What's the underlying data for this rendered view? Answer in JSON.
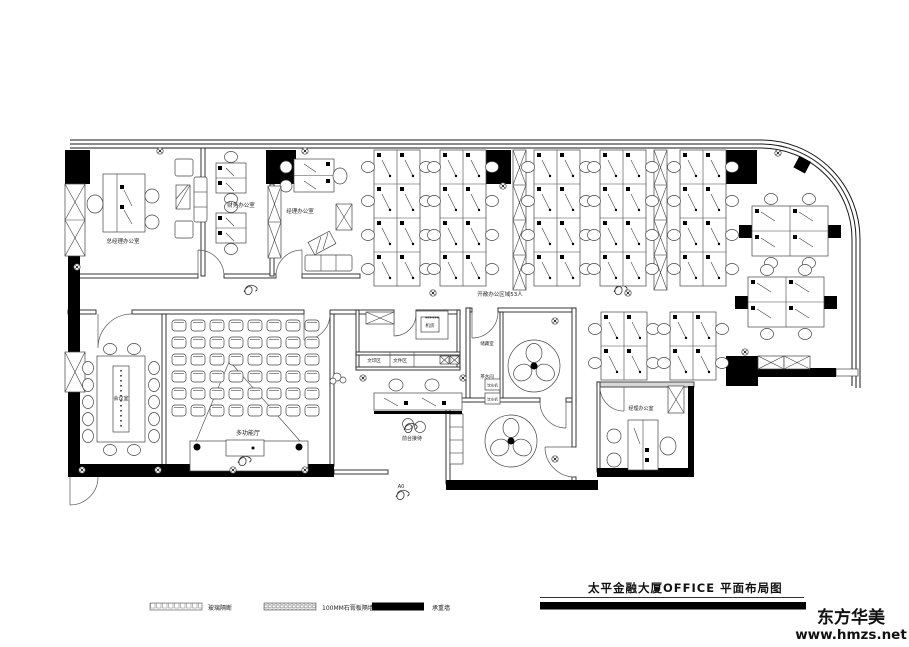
{
  "title_block": {
    "title": "太平金融大厦OFFICE  平面布局图"
  },
  "watermark": {
    "line1": "东方华美",
    "line2": "www.hmzs.net"
  },
  "legend": {
    "items": [
      {
        "label": "玻璃隔断",
        "style": "hatched"
      },
      {
        "label": "100MM石膏板隔墙",
        "style": "dotted"
      },
      {
        "label": "承重墙",
        "style": "solid"
      }
    ]
  },
  "rooms": {
    "gm_office": "总经理办公室",
    "finance_office": "财务办公室",
    "manager_office_top": "经理办公室",
    "open_office": "开敞办公区域53人",
    "meeting_room": "会议室",
    "multi_hall": "多功能厅",
    "reception": "前台接待",
    "server_room": "机房",
    "print_area": "文印区",
    "file_area": "文件区",
    "storage": "储藏室",
    "pantry": "茶水间",
    "water_dispenser": "饮水机",
    "manager_office_right": "经理办公室",
    "entrance": "A0"
  },
  "decor": {
    "stars": "******"
  },
  "colors": {
    "wall": "#000000",
    "line": "#444444",
    "paper": "#ffffff"
  }
}
